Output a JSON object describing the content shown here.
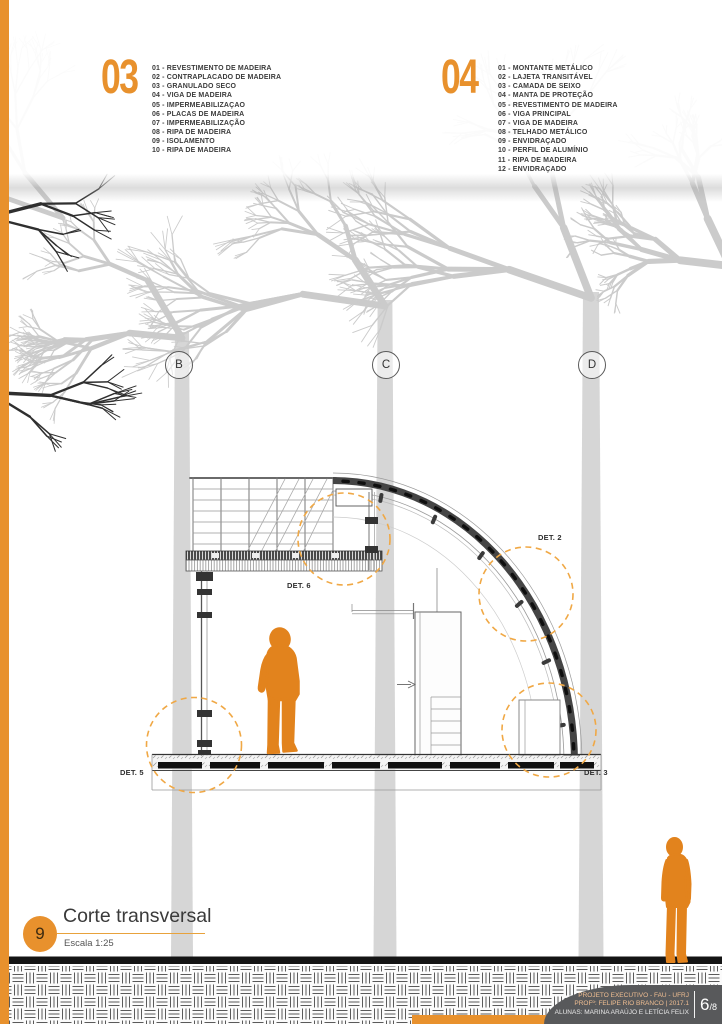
{
  "colors": {
    "accent_orange": "#E8912D",
    "detail_circle_orange": "#F0A845",
    "person_orange": "#E2831D",
    "tree_gray": "#cbcbcb",
    "dark_branch": "#2f2f2f",
    "footer_gray": "#58595B"
  },
  "legend_03": {
    "number": "03",
    "items": [
      "01 - REVESTIMENTO DE MADEIRA",
      "02 - CONTRAPLACADO DE MADEIRA",
      "03 - GRANULADO SECO",
      "04 - VIGA DE MADEIRA",
      "05 - IMPERMEABILIZAÇAO",
      "06 - PLACAS DE MADEIRA",
      "07 - IMPERMEABILIZAÇÃO",
      "08 - RIPA DE MADEIRA",
      "09 - ISOLAMENTO",
      "10 - RIPA DE MADEIRA"
    ]
  },
  "legend_04": {
    "number": "04",
    "items": [
      "01 - MONTANTE METÁLICO",
      "02 - LAJETA TRANSITÁVEL",
      "03 - CAMADA DE SEIXO",
      "04 - MANTA DE PROTEÇÃO",
      "05 - REVESTIMENTO DE MADEIRA",
      "06 - VIGA PRINCIPAL",
      "07 - VIGA DE MADEIRA",
      "08 - TELHADO METÁLICO",
      "09 - ENVIDRAÇADO",
      "10 - PERFIL DE ALUMÍNIO",
      "11 - RIPA DE MADEIRA",
      "12 - ENVIDRAÇADO"
    ]
  },
  "grid_labels": [
    "B",
    "C",
    "D"
  ],
  "details": {
    "det2": "DET. 2",
    "det3": "DET. 3",
    "det5": "DET. 5",
    "det6": "DET. 6"
  },
  "drawing_title": {
    "number": "9",
    "title": "Corte transversal",
    "scale": "Escala 1:25"
  },
  "footer": {
    "credits_line1": "PROJETO EXECUTIVO - FAU - UFRJ",
    "credits_line2": "PROFº: FELIPE RIO BRANCO | 2017.1",
    "credits_line3": "ALUNAS: MARINA ARAÚJO E LETÍCIA FELIX",
    "page_number": "6",
    "page_total": "/8"
  },
  "background": {
    "trees": [
      {
        "x": 182,
        "top": 332,
        "w": 22,
        "seed": 11,
        "trunk": true
      },
      {
        "x": 385,
        "top": 300,
        "w": 23,
        "seed": 22,
        "trunk": true
      },
      {
        "x": 591,
        "top": 292,
        "w": 25,
        "seed": 33,
        "trunk": true
      },
      {
        "x": -20,
        "top": 270,
        "w": 26,
        "seed": 44,
        "trunk": false
      },
      {
        "x": 730,
        "top": 260,
        "w": 26,
        "seed": 55,
        "trunk": false
      },
      {
        "x": 63,
        "top": 212,
        "w": 16,
        "seed": 66,
        "trunk": false
      }
    ],
    "dark_branches": [
      {
        "x": 1,
        "y": 393,
        "angle": 0.05,
        "seed": 77
      },
      {
        "x": 1,
        "y": 214,
        "angle": -0.25,
        "seed": 88
      }
    ]
  }
}
